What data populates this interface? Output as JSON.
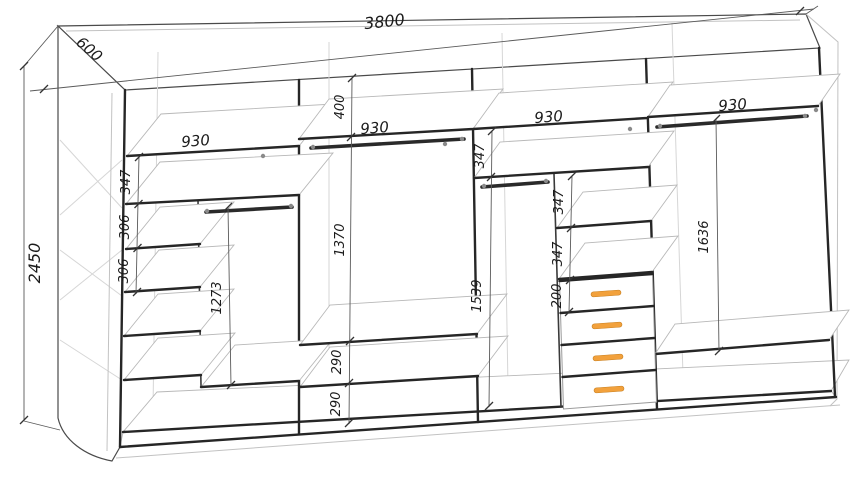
{
  "meta": {
    "drawing_type": "wardrobe interior technical drawing",
    "view": "axonometric front-left"
  },
  "dimensions": {
    "overall": {
      "width": "3800",
      "height": "2450",
      "depth": "600"
    },
    "section1": {
      "shelf_width": "930",
      "gap_top": "347",
      "gap_2": "306",
      "gap_3": "306",
      "hanging_height": "1273"
    },
    "section2": {
      "top_gap": "400",
      "shelf_width": "930",
      "hanging_height": "1370",
      "bottom_gap_1": "290",
      "bottom_gap_2": "290"
    },
    "section3": {
      "shelf_width": "930",
      "gap_below_top": "347",
      "side_gap_1": "347",
      "side_gap_2": "347",
      "drawer_height": "200",
      "hanging_height": "1539"
    },
    "section4": {
      "shelf_width": "930",
      "hanging_height": "1636"
    }
  },
  "components": {
    "sections": 4,
    "hanging_rods": 4,
    "drawers": 4
  },
  "colors": {
    "outline": "#3a3a3a",
    "light_line": "#d6d6d6",
    "dim_text": "#1b1b1b",
    "drawer_handle": "#f2a13c",
    "background": "#ffffff"
  }
}
